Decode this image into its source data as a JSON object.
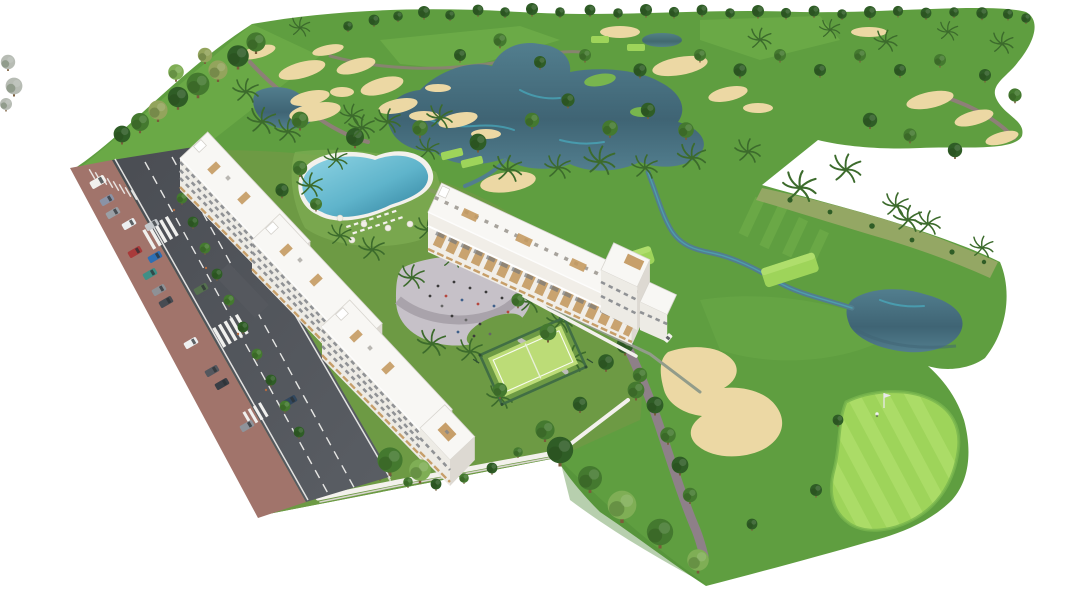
{
  "meta": {
    "alt": "Aerial 3D architectural render of a white low-rise apartment complex with rooftop terraces, lagoon pool, oval playground plaza and fenced paddle court, bordered on the left by a road with traffic and parked cars, and surrounded by a golf course with fairways, lakes, streams, sand bunkers, putting green with flag, palm trees and tree-lined horizon on a white background.",
    "type": "architectural-aerial-render",
    "visible_text": ""
  },
  "palette": {
    "background": "#ffffff",
    "fairway": "#5f9e40",
    "fairway_light": "#78b54e",
    "fairway_dark": "#4c8834",
    "green_bright": "#9ed45a",
    "green_stripe": "#b7e273",
    "rough_scrub": "#9aa768",
    "tree_dark": "#2f5d26",
    "tree_mid": "#44792f",
    "tree_light": "#7fae55",
    "tree_olive": "#93a45c",
    "tree_gray": "#b7bcb4",
    "palm": "#3c6b2c",
    "sand": "#ecd8a4",
    "water_deep": "#3f6474",
    "water": "#527e8e",
    "water_teal": "#49b8cc",
    "pool": "#5fb4cb",
    "path": "#8e7f78",
    "path_purple": "#8e8088",
    "road": "#4a4d53",
    "sidewalk": "#a1746b",
    "marking": "#f2f2f0",
    "building": "#f8f7f4",
    "facade": "#edebe5",
    "facade_shadow": "#ddd9d2",
    "window": "#70747a",
    "wood": "#c49a62",
    "wall": "#f3f1ec",
    "court": "#bcdc77",
    "court_fence": "#3f6b45",
    "gabion": "#929c8a",
    "plaza": "#c6c1c8",
    "plaza_band": "#a9a3ab",
    "lawn": "#6d9a44",
    "people": "#3a3a3a",
    "flag": "#e8e8e8"
  },
  "cars": [
    {
      "label": "white van",
      "color": "#f2f1ee"
    },
    {
      "label": "blue-gray car",
      "color": "#8a93a6"
    },
    {
      "label": "gray car",
      "color": "#9aa0a6"
    },
    {
      "label": "white car",
      "color": "#eceff1"
    },
    {
      "label": "silver car",
      "color": "#c6cacd"
    },
    {
      "label": "red car",
      "color": "#a93a3a"
    },
    {
      "label": "blue car",
      "color": "#2f6fb3"
    },
    {
      "label": "teal car",
      "color": "#3f8f86"
    },
    {
      "label": "gray car",
      "color": "#8e9196"
    },
    {
      "label": "charcoal car",
      "color": "#474b52"
    },
    {
      "label": "green car",
      "color": "#55714e"
    },
    {
      "label": "white car",
      "color": "#eef0f1"
    },
    {
      "label": "dark gray car",
      "color": "#54575e"
    },
    {
      "label": "charcoal car",
      "color": "#3a3e45"
    },
    {
      "label": "dark blue car",
      "color": "#31475e"
    },
    {
      "label": "gray car",
      "color": "#8f939a"
    },
    {
      "label": "golf cart",
      "color": "#f4f3f0"
    }
  ]
}
